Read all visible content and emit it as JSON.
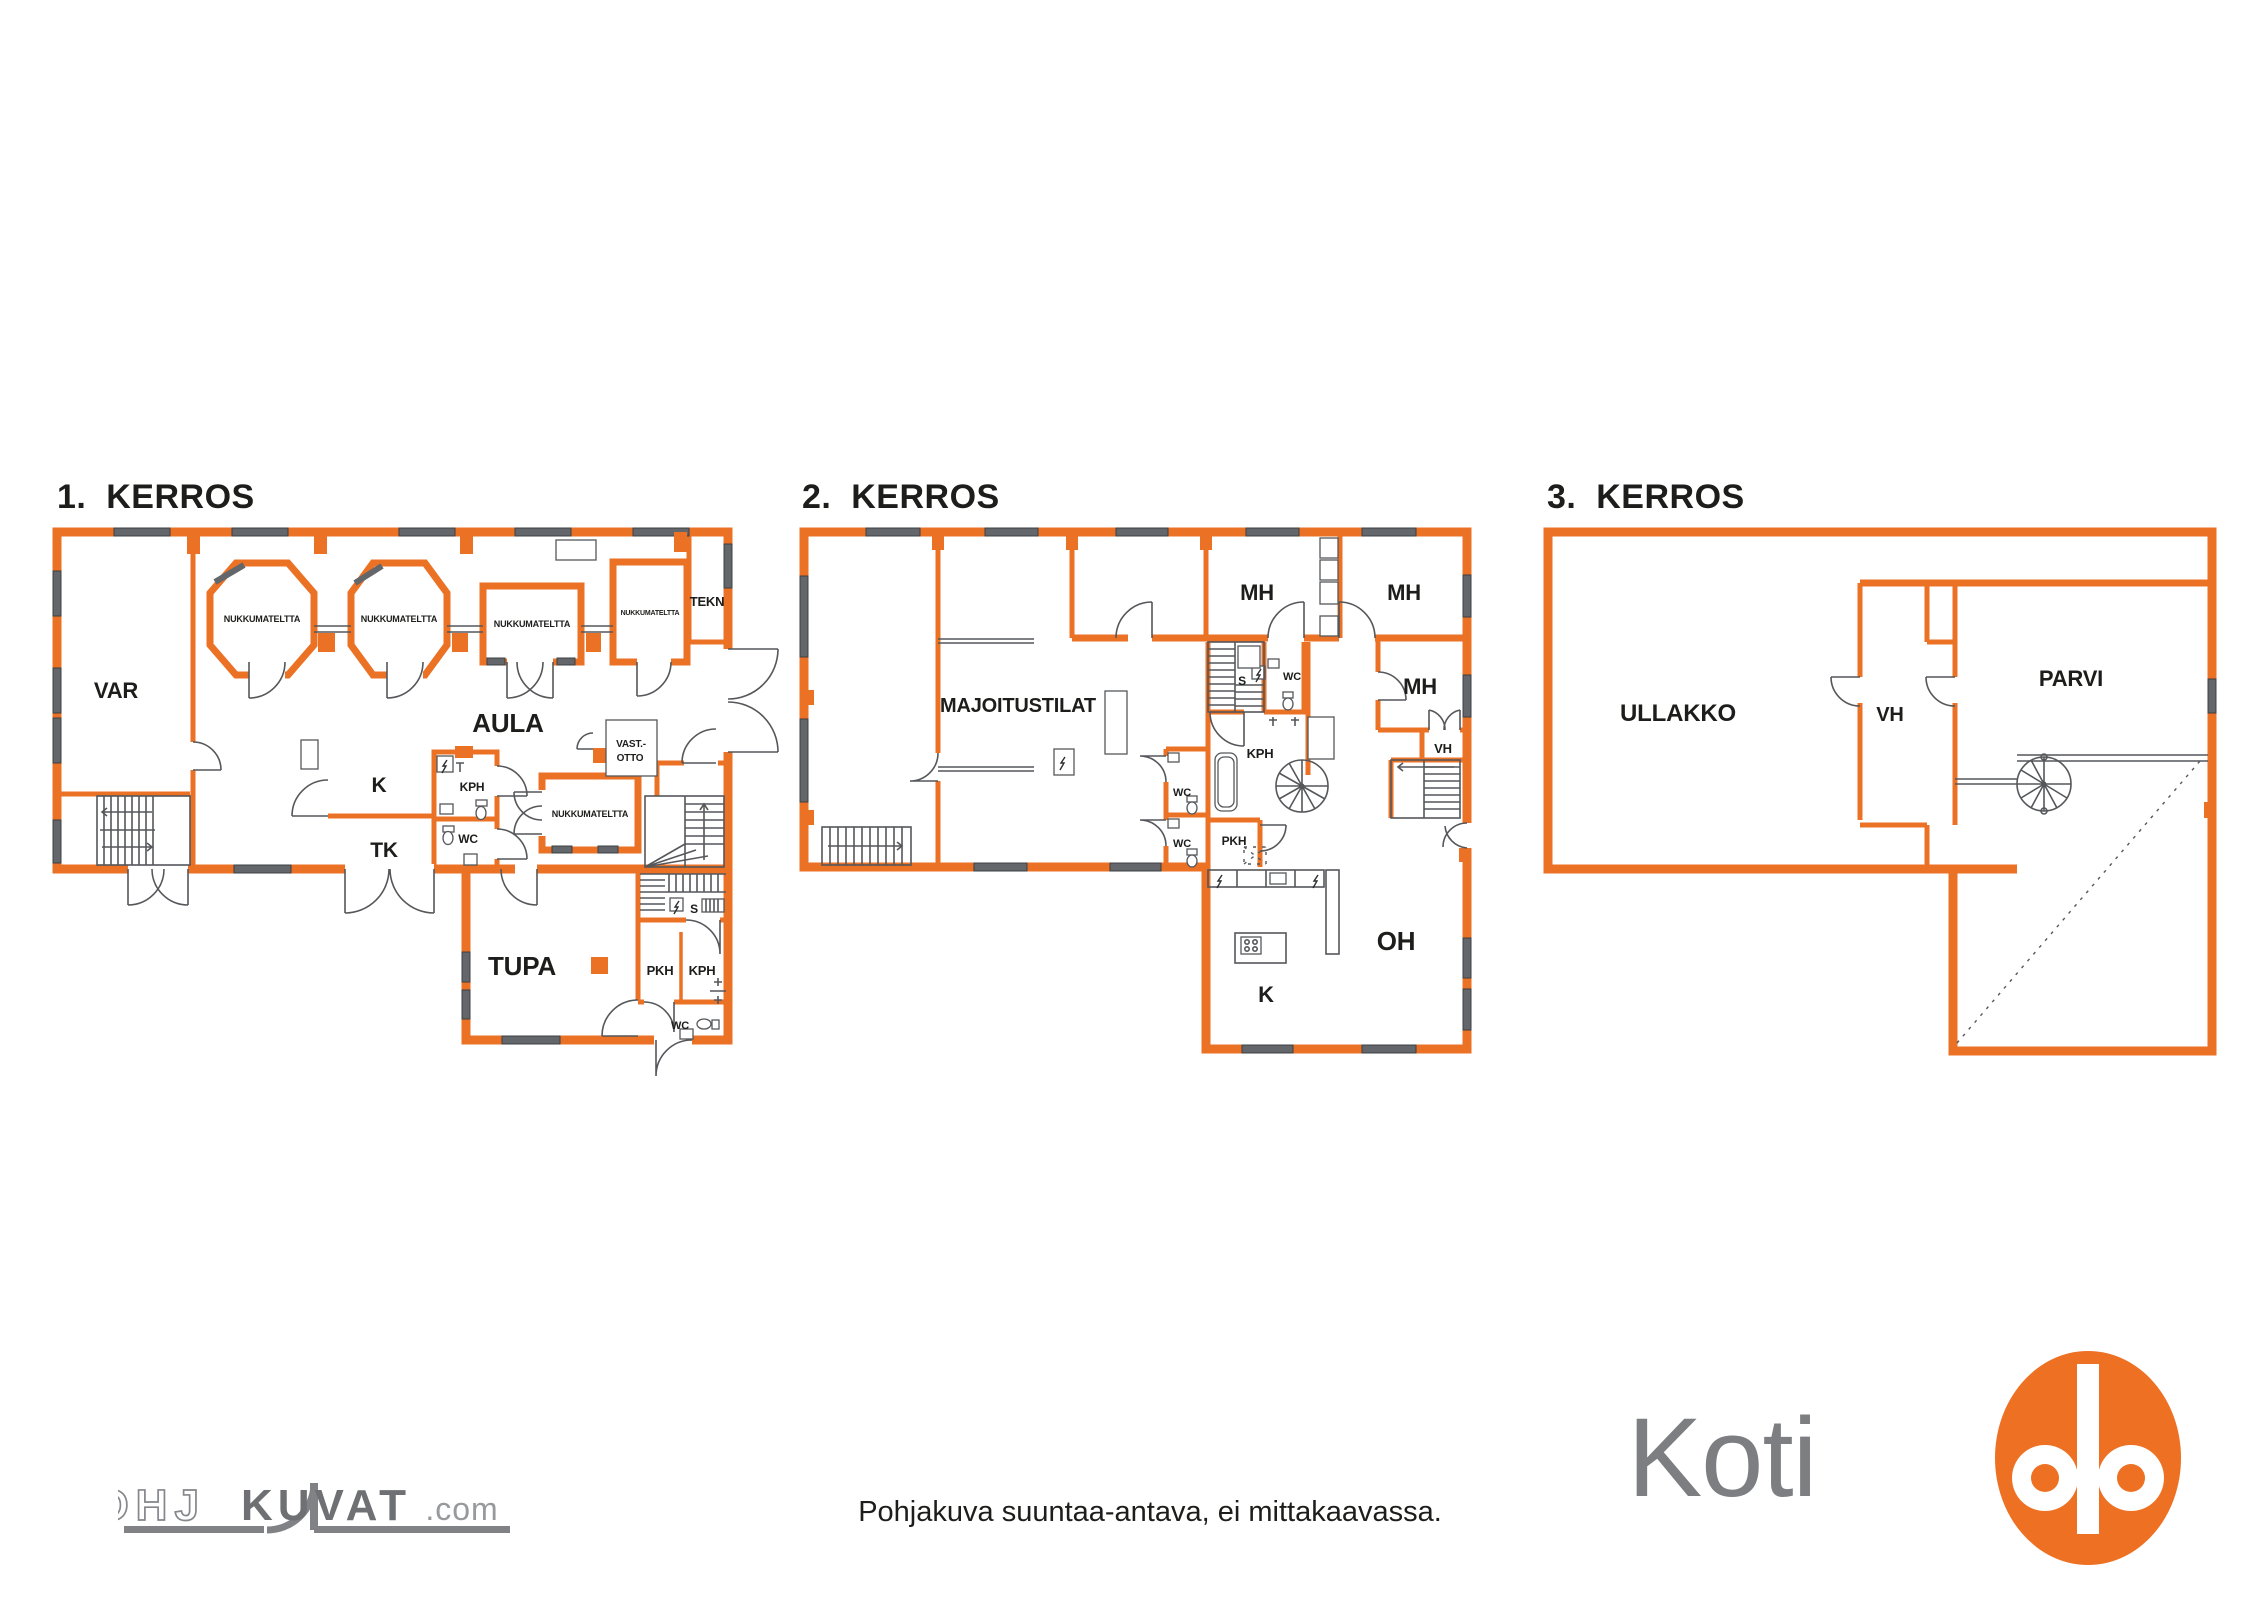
{
  "colors": {
    "wall": "#EB7124",
    "win": "#63666A",
    "line": "#55575A",
    "op_orange": "#EE7023"
  },
  "floors": [
    {
      "title": "1.  KERROS",
      "rooms": [
        "VAR",
        "NUKKUMATELTTA",
        "NUKKUMATELTTA",
        "NUKKUMATELTTA",
        "NUKKUMATELTTA",
        "TEKN",
        "AULA",
        "K",
        "KPH",
        "WC",
        "TK",
        "NUKKUMATELTTA",
        "VAST.-",
        "OTTO",
        "S",
        "TUPA",
        "PKH",
        "KPH",
        "WC"
      ]
    },
    {
      "title": "2.  KERROS",
      "rooms": [
        "MAJOITUSTILAT",
        "MH",
        "MH",
        "MH",
        "S",
        "WC",
        "KPH",
        "WC",
        "WC",
        "PKH",
        "VH",
        "OH",
        "K"
      ]
    },
    {
      "title": "3.  KERROS",
      "rooms": [
        "ULLAKKO",
        "VH",
        "PARVI"
      ]
    }
  ],
  "footer": {
    "disclaimer": "Pohjakuva suuntaa-antava, ei mittakaavassa."
  },
  "branding": {
    "pohjakuvat_1": "POHJ",
    "pohjakuvat_2": "KUVAT",
    "pohjakuvat_3": ".com",
    "opkoti_text": "OP Koti"
  }
}
